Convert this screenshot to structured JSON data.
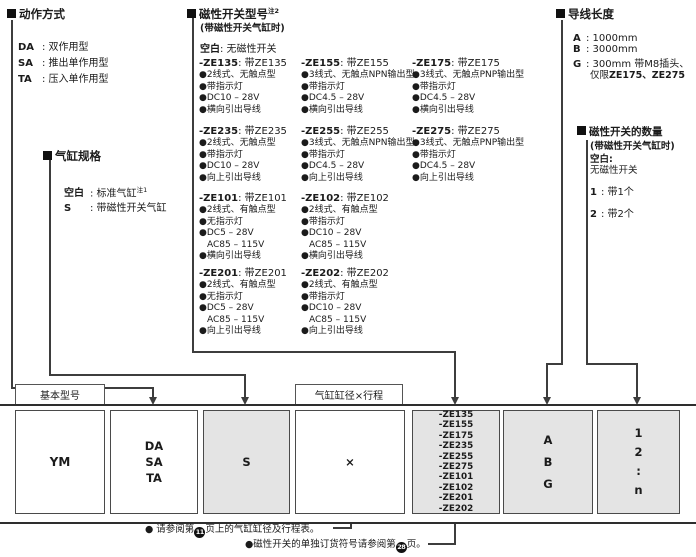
{
  "action": {
    "title": "动作方式",
    "items": [
      {
        "term": "DA",
        "desc": ": 双作用型"
      },
      {
        "term": "SA",
        "desc": ": 推出单作用型"
      },
      {
        "term": "TA",
        "desc": ": 压入单作用型"
      }
    ]
  },
  "spec": {
    "title": "气缸规格",
    "items": [
      {
        "term": "空白",
        "desc": ": 标准气缸",
        "sup": "注1"
      },
      {
        "term": "S",
        "desc": ": 带磁性开关气缸",
        "sup": ""
      }
    ]
  },
  "sw": {
    "title": "磁性开关型号",
    "title_sup": "注2",
    "subtitle": "(带磁性开关气缸时)",
    "blank_term": "空白",
    "blank_desc": ": 无磁性开关",
    "groups": [
      {
        "code": "-ZE135",
        "rest": ": 带ZE135",
        "l1": "●2线式、无触点型",
        "l2": "●带指示灯",
        "l3": "●DC10 – 28V",
        "l4": "●横向引出导线"
      },
      {
        "code": "-ZE155",
        "rest": ": 带ZE155",
        "l1": "●3线式、无触点NPN输出型",
        "l2": "●带指示灯",
        "l3": "●DC4.5 – 28V",
        "l4": "●横向引出导线"
      },
      {
        "code": "-ZE175",
        "rest": ": 带ZE175",
        "l1": "●3线式、无触点PNP输出型",
        "l2": "●带指示灯",
        "l3": "●DC4.5 – 28V",
        "l4": "●横向引出导线"
      },
      {
        "code": "-ZE235",
        "rest": ": 带ZE235",
        "l1": "●2线式、无触点型",
        "l2": "●带指示灯",
        "l3": "●DC10 – 28V",
        "l4": "●向上引出导线"
      },
      {
        "code": "-ZE255",
        "rest": ": 带ZE255",
        "l1": "●3线式、无触点NPN输出型",
        "l2": "●带指示灯",
        "l3": "●DC4.5 – 28V",
        "l4": "●向上引出导线"
      },
      {
        "code": "-ZE275",
        "rest": ": 带ZE275",
        "l1": "●3线式、无触点PNP输出型",
        "l2": "●带指示灯",
        "l3": "●DC4.5 – 28V",
        "l4": "●向上引出导线"
      },
      {
        "code": "-ZE101",
        "rest": ": 带ZE101",
        "l1": "●2线式、有触点型",
        "l2": "●无指示灯",
        "l3": "●DC5 – 28V",
        "ac": "AC85 – 115V",
        "l4": "●横向引出导线"
      },
      {
        "code": "-ZE102",
        "rest": ": 带ZE102",
        "l1": "●2线式、有触点型",
        "l2": "●带指示灯",
        "l3": "●DC10 – 28V",
        "ac": "AC85 – 115V",
        "l4": "●横向引出导线"
      },
      {
        "code": "-ZE201",
        "rest": ": 带ZE201",
        "l1": "●2线式、有触点型",
        "l2": "●无指示灯",
        "l3": "●DC5 – 28V",
        "ac": "AC85 – 115V",
        "l4": "●向上引出导线"
      },
      {
        "code": "-ZE202",
        "rest": ": 带ZE202",
        "l1": "●2线式、有触点型",
        "l2": "●带指示灯",
        "l3": "●DC10 – 28V",
        "ac": "AC85 – 115V",
        "l4": "●向上引出导线"
      }
    ]
  },
  "lead": {
    "title": "导线长度",
    "items": [
      {
        "term": "A",
        "desc": ": 1000mm"
      },
      {
        "term": "B",
        "desc": ": 3000mm"
      },
      {
        "term": "G",
        "desc": ": 300mm 带M8插头、"
      }
    ],
    "g_note_pre": "仅限",
    "g_note_codes": "ZE175、ZE275"
  },
  "qty": {
    "title": "磁性开关的数量",
    "subtitle": "(带磁性开关气缸时)",
    "blank_term": "空白:",
    "blank_desc": "无磁性开关",
    "items": [
      {
        "term": "1",
        "desc": ": 带1个"
      },
      {
        "term": "2",
        "desc": ": 带2个"
      }
    ]
  },
  "table": {
    "label_basic": "基本型号",
    "label_bore": "气缸缸径×行程",
    "b1": "YM",
    "b2": [
      "DA",
      "SA",
      "TA"
    ],
    "b3": "S",
    "b4": "×",
    "b5": [
      "-ZE135",
      "-ZE155",
      "-ZE175",
      "-ZE235",
      "-ZE255",
      "-ZE275",
      "-ZE101",
      "-ZE102",
      "-ZE201",
      "-ZE202"
    ],
    "b6": [
      "A",
      "B",
      "G"
    ],
    "b7": [
      "1",
      "2",
      ":",
      "n"
    ]
  },
  "notes": {
    "n1_pre": "● 请参阅第",
    "n1_num": "11",
    "n1_post": "页上的气缸缸径及行程表。",
    "n2_pre": "●磁性开关的单独订货符号请参阅第",
    "n2_num": "28",
    "n2_post": "页。"
  },
  "colors": {
    "line": "#3d3d3d",
    "box_fill_gray": "#e4e4e4",
    "text": "#1b1b1b"
  }
}
